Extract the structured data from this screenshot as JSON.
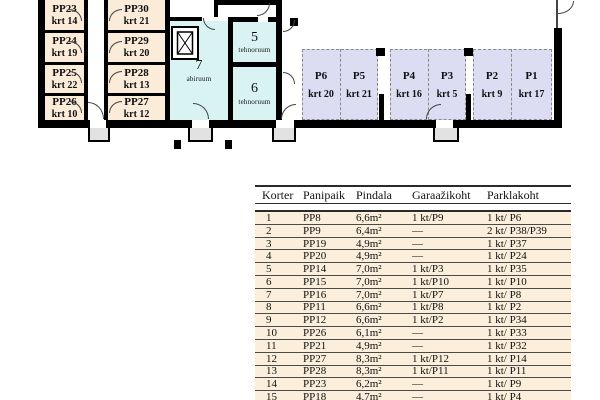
{
  "plan": {
    "storage_rooms": [
      {
        "name": "PP23",
        "krt": "krt 14"
      },
      {
        "name": "PP24",
        "krt": "krt 19"
      },
      {
        "name": "PP25",
        "krt": "krt 22"
      },
      {
        "name": "PP26",
        "krt": "krt 10"
      },
      {
        "name": "PP30",
        "krt": "krt 21"
      },
      {
        "name": "PP29",
        "krt": "krt 20"
      },
      {
        "name": "PP28",
        "krt": "krt 13"
      },
      {
        "name": "PP27",
        "krt": "krt 12"
      }
    ],
    "tech_rooms": [
      {
        "number": "5",
        "label": "tehnoruum"
      },
      {
        "number": "6",
        "label": "tehnoruum"
      },
      {
        "number": "7",
        "label": "abiruum"
      }
    ],
    "parking_spots": [
      {
        "name": "P6",
        "krt": "krt 20"
      },
      {
        "name": "P5",
        "krt": "krt 21"
      },
      {
        "name": "P4",
        "krt": "krt 16"
      },
      {
        "name": "P3",
        "krt": "krt 5"
      },
      {
        "name": "P2",
        "krt": "krt 9"
      },
      {
        "name": "P1",
        "krt": "krt 17"
      }
    ],
    "colors": {
      "storage_room": "#faecd9",
      "tech_room": "#d9f3f3",
      "parking_spot": "#dcdcf2",
      "wall": "#000000",
      "table_row": "#fbeeda"
    }
  },
  "table": {
    "headers": [
      "Korter",
      "Panipaik",
      "Pindala",
      "Garaažikoht",
      "Parklakoht"
    ],
    "rows": [
      [
        "1",
        "PP8",
        "6,6m²",
        "1 kt/P9",
        "1 kt/ P6"
      ],
      [
        "2",
        "PP9",
        "6,4m²",
        "—",
        "2 kt/ P38/P39"
      ],
      [
        "3",
        "PP19",
        "4,9m²",
        "—",
        "1 kt/ P37"
      ],
      [
        "4",
        "PP20",
        "4,9m²",
        "—",
        "1 kt/ P24"
      ],
      [
        "5",
        "PP14",
        "7,0m²",
        "1 kt/P3",
        "1 kt/ P35"
      ],
      [
        "6",
        "PP15",
        "7,0m²",
        "1 kt/P10",
        "1 kt/ P10"
      ],
      [
        "7",
        "PP16",
        "7,0m²",
        "1 kt/P7",
        "1 kt/ P8"
      ],
      [
        "8",
        "PP11",
        "6,6m²",
        "1 kt/P8",
        "1 kt/ P2"
      ],
      [
        "9",
        "PP12",
        "6,6m²",
        "1 kt/P2",
        "1 kt/ P34"
      ],
      [
        "10",
        "PP26",
        "6,1m²",
        "—",
        "1 kt/ P33"
      ],
      [
        "11",
        "PP21",
        "4,9m²",
        "—",
        "1 kt/ P32"
      ],
      [
        "12",
        "PP27",
        "8,3m²",
        "1 kt/P12",
        "1 kt/ P14"
      ],
      [
        "13",
        "PP28",
        "8,3m²",
        "1 kt/P11",
        "1 kt/ P11"
      ],
      [
        "14",
        "PP23",
        "6,2m²",
        "—",
        "1 kt/ P9"
      ],
      [
        "15",
        "PP18",
        "4,7m²",
        "—",
        "1 kt/ P4"
      ]
    ]
  }
}
